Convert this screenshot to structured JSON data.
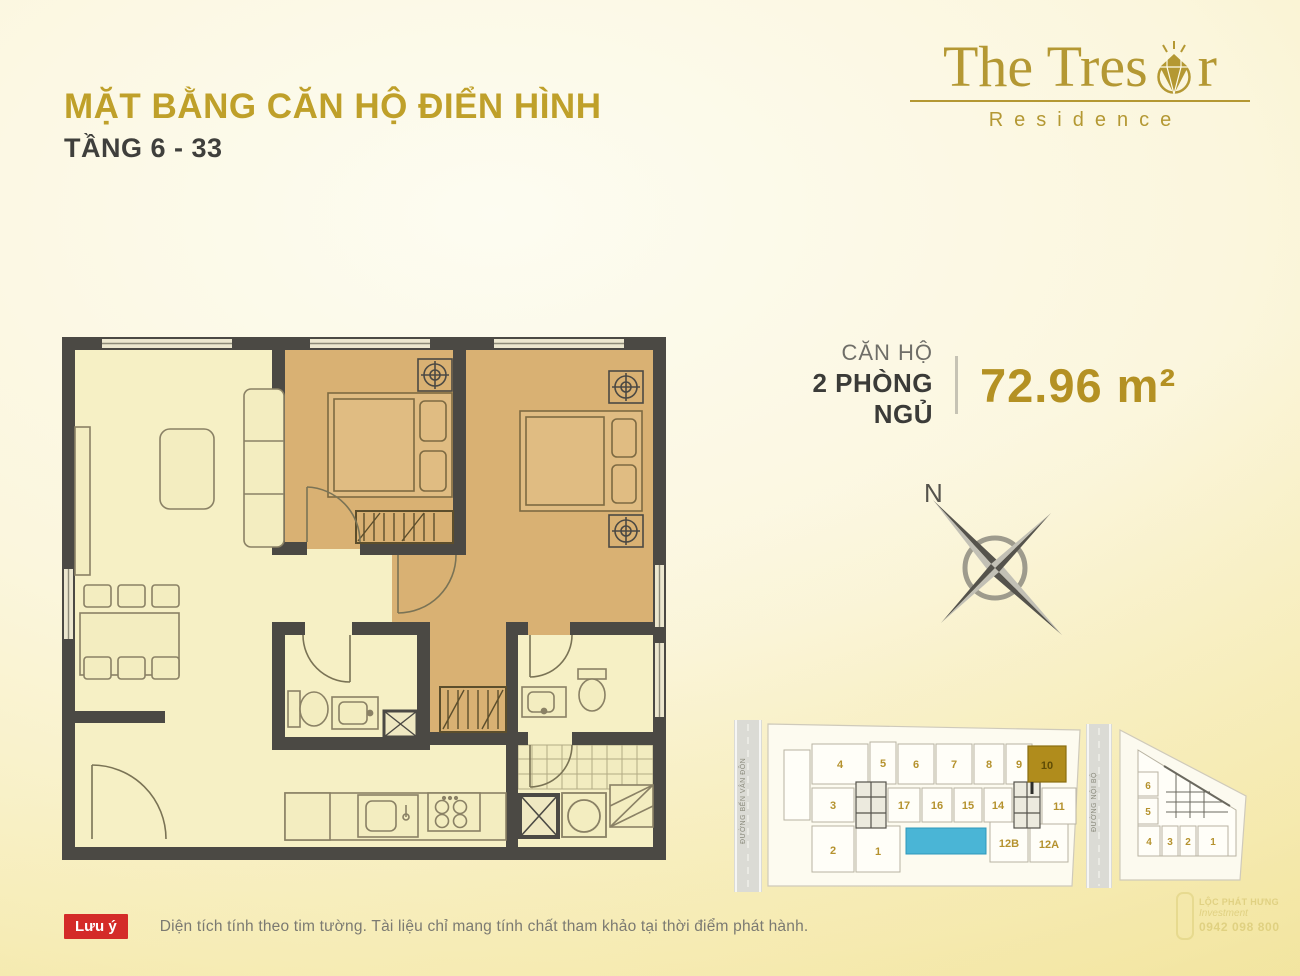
{
  "header": {
    "title": "MẶT BẰNG CĂN HỘ ĐIỂN HÌNH",
    "subtitle": "TẦNG 6 - 33"
  },
  "logo": {
    "brand_prefix": "The Tres",
    "brand_suffix": "r",
    "tagline": "Residence"
  },
  "unit_info": {
    "label": "CĂN HỘ",
    "type": "2 PHÒNG NGỦ",
    "area": "72.96 m²"
  },
  "compass": {
    "north": "N"
  },
  "colors": {
    "accent_gold": "#bfa02a",
    "wall": "#4b4944",
    "bedroom_fill": "#d9b173",
    "living_fill": "#f6f0c5",
    "pool": "#4ab5d6",
    "note_badge_red": "#d42b28",
    "highlight_unit_gold": "#b08c1c"
  },
  "siteplan": {
    "road_left": "ĐƯỜNG BẾN VÂN ĐỒN",
    "road_right": "ĐƯỜNG NỘI BỘ",
    "highlighted_unit": "10",
    "building1_units": [
      "4",
      "5",
      "6",
      "7",
      "8",
      "9",
      "10",
      "3",
      "17",
      "16",
      "15",
      "14",
      "11",
      "2",
      "1",
      "12B",
      "12A"
    ],
    "building2_units": [
      "6",
      "5",
      "4",
      "3",
      "2",
      "1"
    ]
  },
  "note": {
    "badge": "Lưu ý",
    "text": "Diện tích tính theo tim tường. Tài liệu chỉ mang tính chất tham khảo tại thời điểm phát hành."
  },
  "watermark": {
    "line1": "LỘC PHÁT HƯNG",
    "line2": "Investment",
    "line3": "0942 098 800"
  }
}
